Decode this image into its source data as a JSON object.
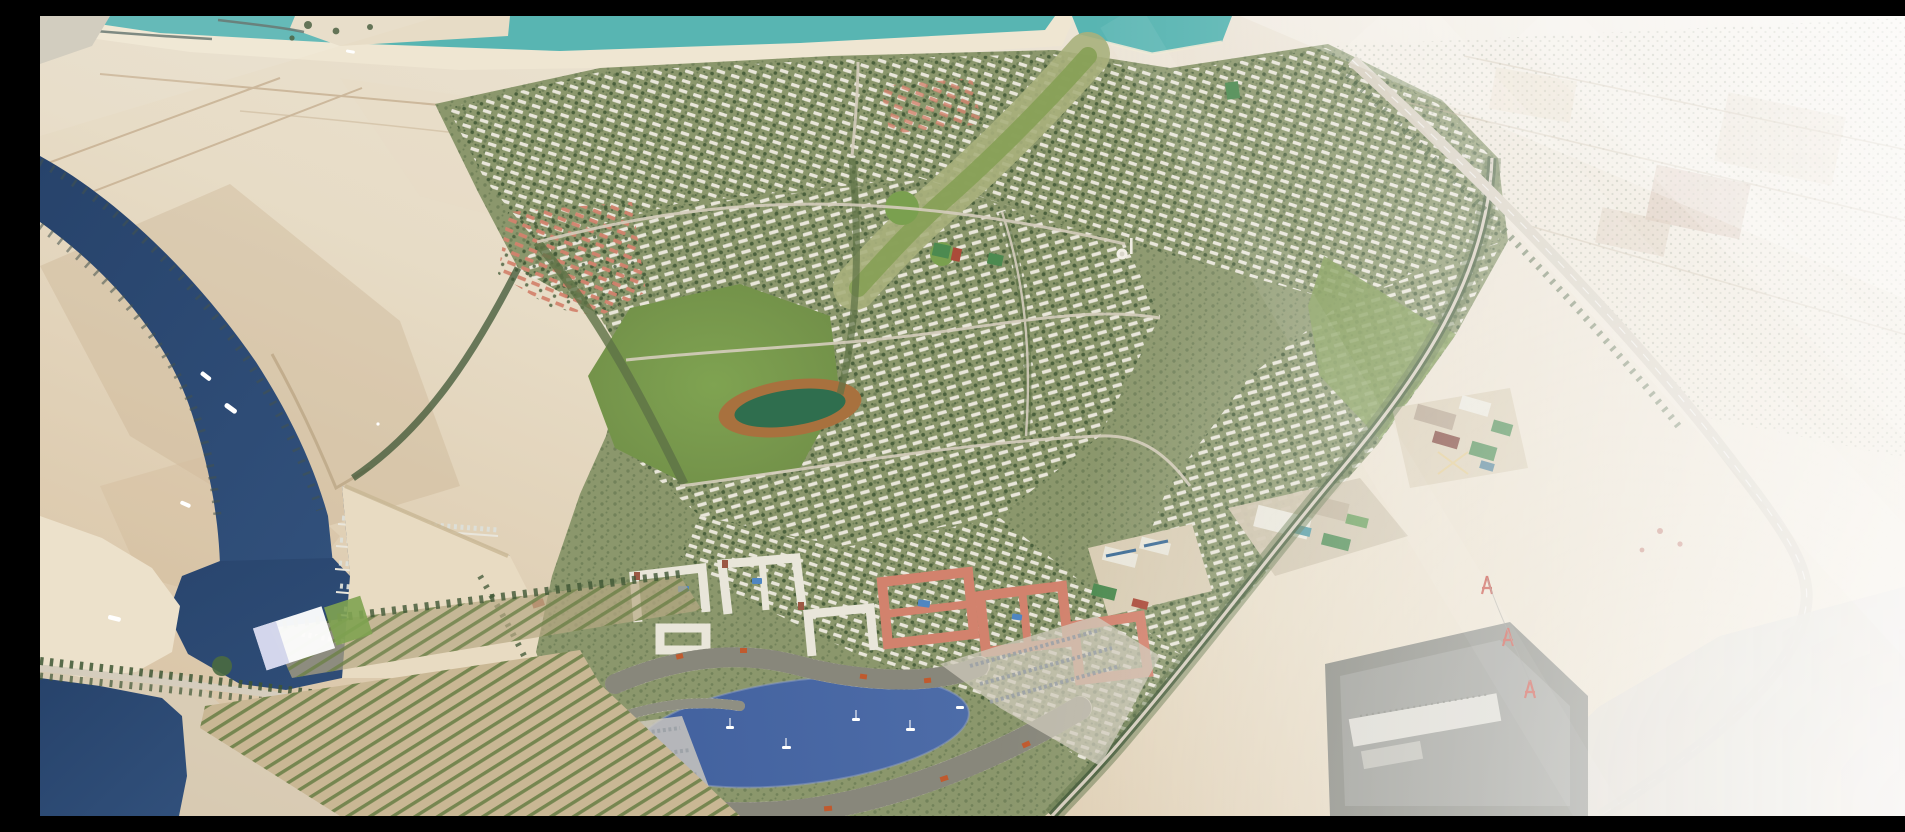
{
  "meta": {
    "title": "Aerial master-plan rendering of a waterfront desert community with marina, canal, villa districts and crescent lagoon",
    "image_width": 1905,
    "image_height": 800,
    "visible_text": "none",
    "style": "photoreal architectural bird's-eye render, hazy daylight"
  },
  "scene": {
    "type": "architectural-aerial-render",
    "palette": {
      "sand": "#d6bf9f",
      "sand_dark": "#c7ad8c",
      "sand_light": "#e7dcc6",
      "sand_gray": "#d9d2c2",
      "haze": "#f4f1ec",
      "white": "#ffffff",
      "sea_teal": "#58b5b2",
      "canal_blue": "#31507b",
      "canal_deep": "#27436b",
      "lagoon_blue": "#4d6ca8",
      "beach_white": "#efe6d2",
      "dev_base": "#8b976c",
      "dev_green": "#5e7246",
      "tree_green": "#3e5634",
      "park_green": "#7fa351",
      "field_green": "#2f6e4e",
      "pitch_green": "#4c8a50",
      "track_brown": "#a8713e",
      "roof_white": "#e9e6da",
      "roof_salmon": "#d2826d",
      "terrace_cream": "#ddd8c8",
      "terrace_dark": "#41463c",
      "roof_orange": "#c05a2e",
      "pool_blue": "#4f86c2",
      "court_red": "#ab4a39",
      "solar_blue": "#3f6d96",
      "road_light": "#d5cdbd",
      "road_tan": "#bfa887",
      "concrete": "#d7d2c9",
      "substation_gray": "#7e7f76",
      "building_tan": "#d9cdb4",
      "maroon_roof": "#7e4338",
      "tower_red": "#c0392b",
      "plaza_blue": "#cfd3ea"
    },
    "regions": [
      {
        "id": "sea",
        "label": "Turquoise sea with breakwaters and beach along the top edge"
      },
      {
        "id": "tidal-lake",
        "label": "Turquoise inland lake, top centre-right"
      },
      {
        "id": "desert",
        "label": "Open tan desert with faint dirt tracks, upper left"
      },
      {
        "id": "canal",
        "label": "Navy canal winding from top-left, groynes on both banks, white yachts"
      },
      {
        "id": "marina",
        "label": "Marina basin with jetties and rows of moored boats"
      },
      {
        "id": "beach-spit",
        "label": "White sand spit inside the canal mouth"
      },
      {
        "id": "causeway",
        "label": "Tree-lined causeway crossing the canal, bottom-left"
      },
      {
        "id": "orchard",
        "label": "Striped orchard and nursery planting rows, bottom-left centre"
      },
      {
        "id": "event-plaza",
        "label": "White waterfront event plaza with lawn"
      },
      {
        "id": "development",
        "label": "Master-planned community of curving villa and townhouse rows"
      },
      {
        "id": "pink-district",
        "label": "Salmon-roofed housing cluster, centre-left"
      },
      {
        "id": "central-park",
        "label": "Central park with running-track oval and dark green infield"
      },
      {
        "id": "wadi",
        "label": "Green wadi / golf corridor running from the lake to the park"
      },
      {
        "id": "sports-courts",
        "label": "Small green and red sports courts near the mosque"
      },
      {
        "id": "mosque",
        "label": "Small white domed mosque with minaret"
      },
      {
        "id": "school-campus",
        "label": "School campus with maroon roof, pitches and courts, centre-right"
      },
      {
        "id": "community-campus",
        "label": "Community centre with teal pool and lawns"
      },
      {
        "id": "solar-school",
        "label": "School with blue solar roofs, pitch and red courts"
      },
      {
        "id": "lagoon",
        "label": "Blue crescent lagoon with white sailboats, bottom centre"
      },
      {
        "id": "crescent-terraces",
        "label": "Curved cream terraced apartment bands with orange roofs around the lagoon"
      },
      {
        "id": "white-apartments",
        "label": "Cream U-shaped apartment blocks with courtyard pools"
      },
      {
        "id": "salmon-complexes",
        "label": "Terracotta-roofed courtyard apartment complexes"
      },
      {
        "id": "parking",
        "label": "Surface parking lots with rows of cars"
      },
      {
        "id": "boundary-road",
        "label": "Tree-lined boundary road along the community's east edge"
      },
      {
        "id": "highway",
        "label": "Highway curving down the right side of the frame"
      },
      {
        "id": "palm-farms",
        "label": "Hazy palm plantations and field plots, top right"
      },
      {
        "id": "substation",
        "label": "Fenced utility substation compound, bottom right"
      },
      {
        "id": "power-line",
        "label": "Red-and-white electricity transmission towers"
      },
      {
        "id": "haze",
        "label": "Bright atmospheric haze washing out the right side"
      }
    ],
    "counts": {
      "canal_yachts": 5,
      "marina_jetties": 5,
      "lagoon_sailboats": 5,
      "transmission_towers": 3,
      "breakwaters": 2
    }
  }
}
